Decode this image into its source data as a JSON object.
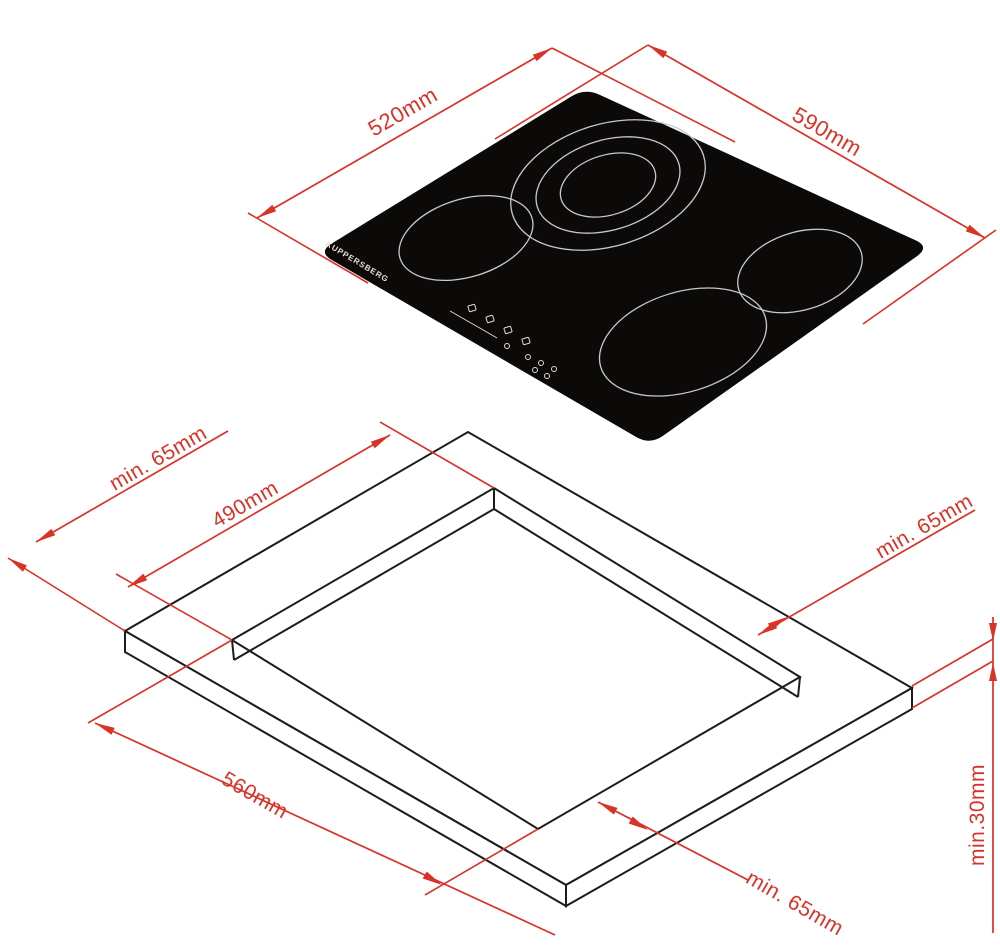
{
  "colors": {
    "dimension_red": "#d93227",
    "outline_black": "#1c1c1c",
    "hob_black": "#0c0909",
    "burner_ring_gray": "#c9c9c9",
    "brand_white": "#e3e0dc"
  },
  "hob": {
    "brand": "KUPPERSBERG",
    "depth_label": "520mm",
    "width_label": "590mm"
  },
  "cutout": {
    "depth_label": "490mm",
    "width_label": "560mm",
    "clearance_top_left": "min. 65mm",
    "clearance_top_right": "min. 65mm",
    "clearance_bottom": "min. 65mm",
    "worktop_thickness_label": "min.30mm"
  }
}
